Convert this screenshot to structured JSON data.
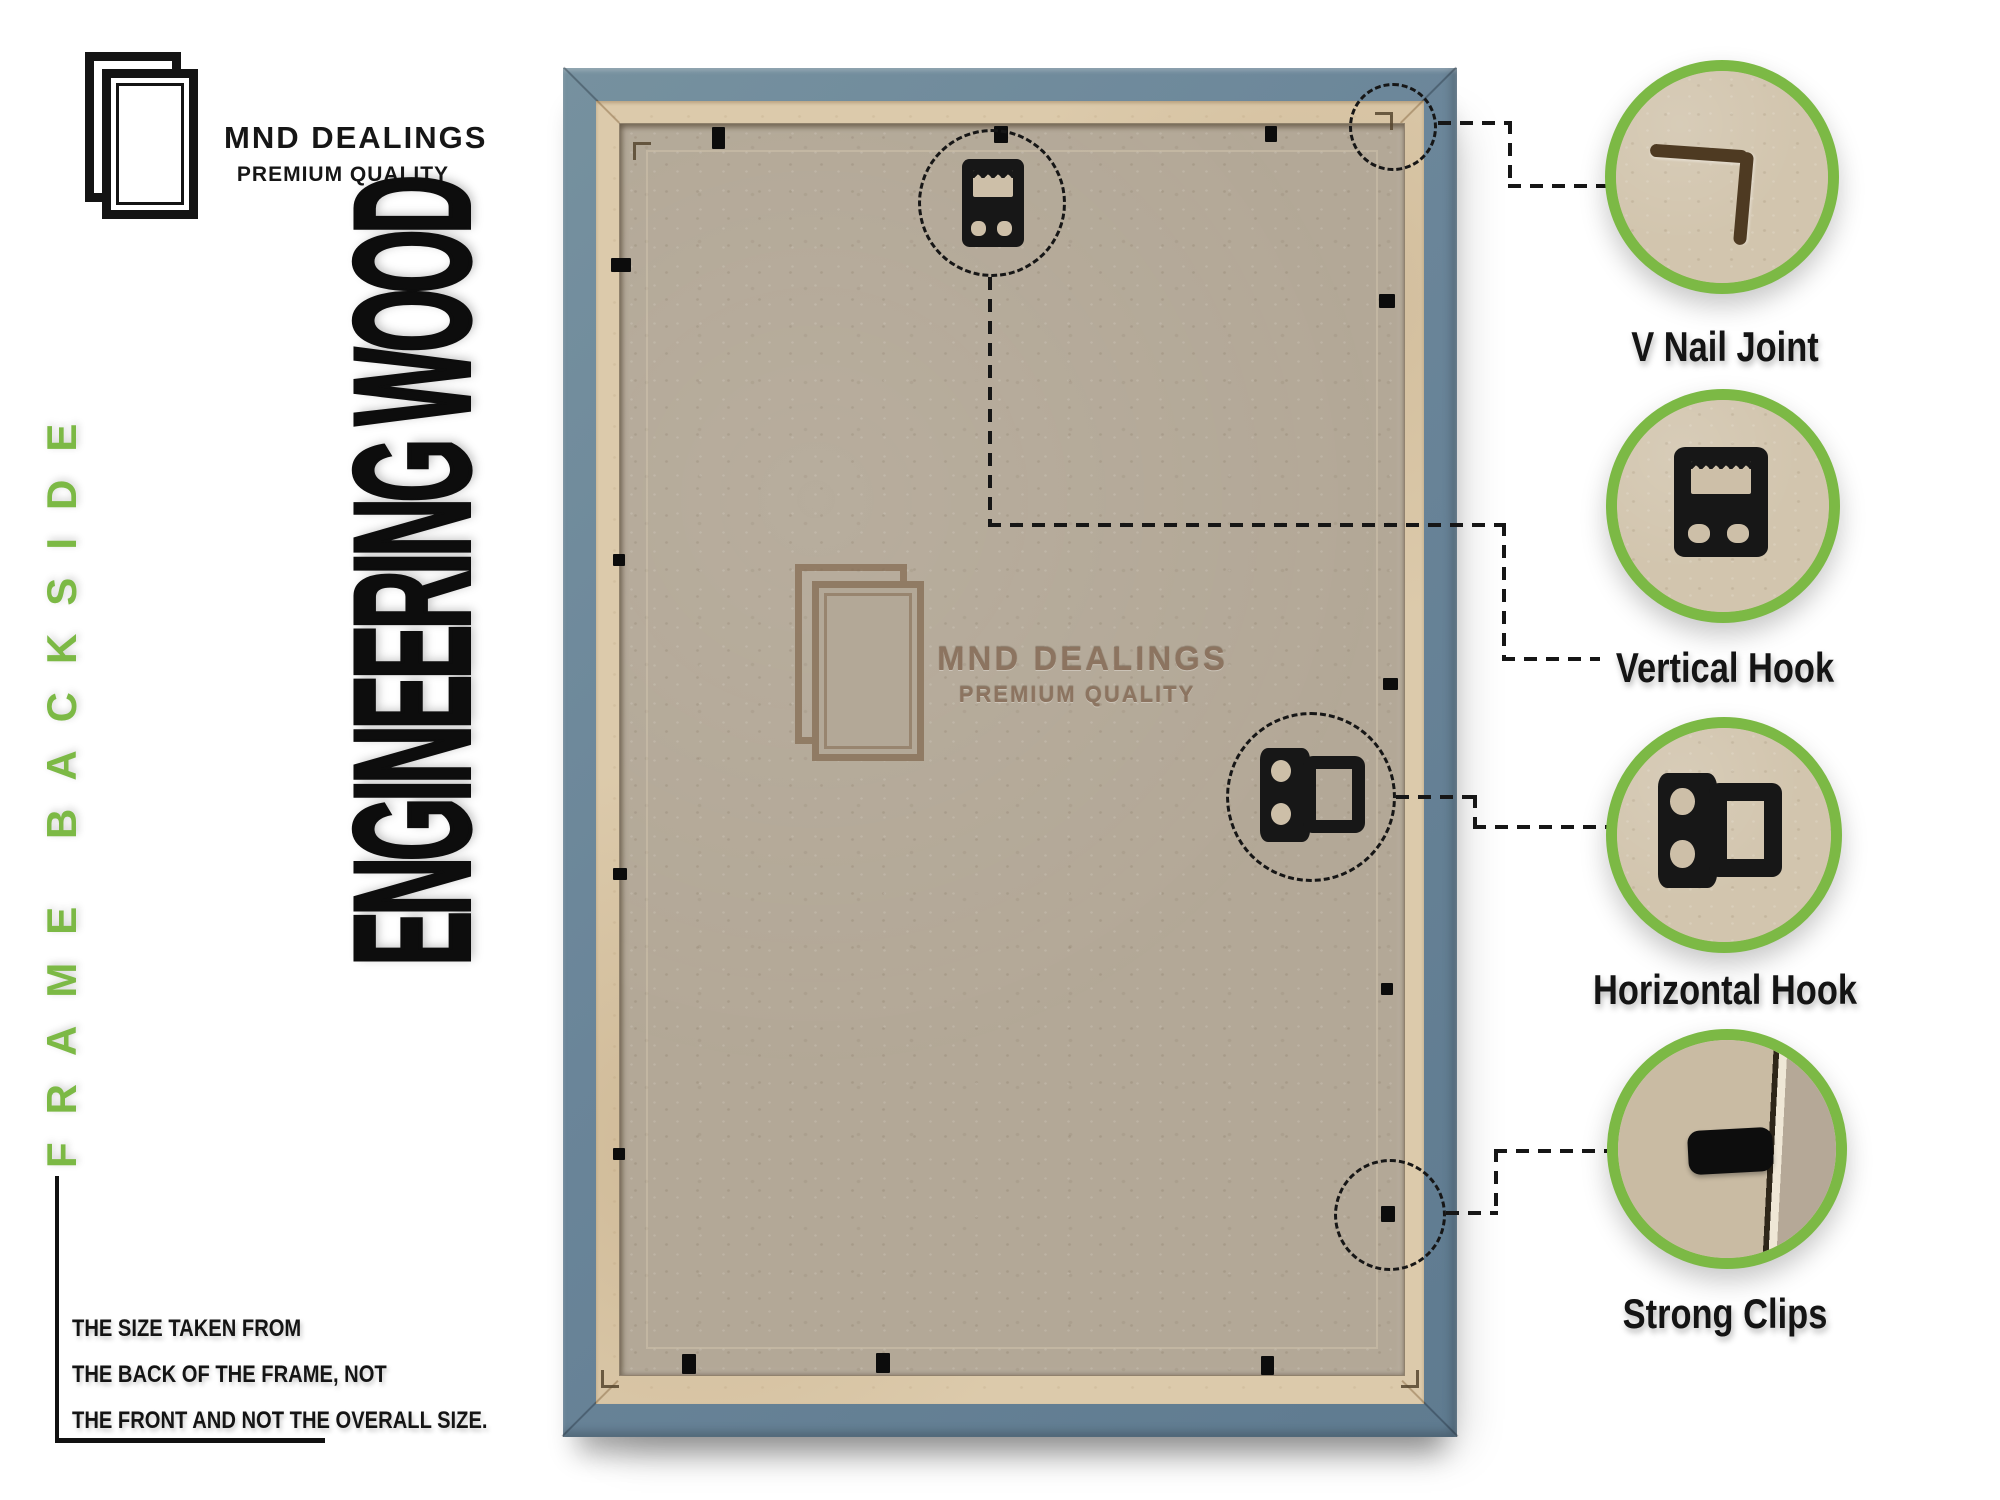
{
  "brand": {
    "name": "MND DEALINGS",
    "tagline": "PREMIUM QUALITY"
  },
  "side_label": "FRAME BACKSIDE",
  "material_label": "ENGINEERING WOOD",
  "size_note": {
    "line1": "THE SIZE TAKEN FROM",
    "line2": "THE BACK OF THE FRAME, NOT",
    "line3": "THE FRONT AND NOT THE OVERALL SIZE."
  },
  "watermark": {
    "name": "MND DEALINGS",
    "tagline": "PREMIUM QUALITY"
  },
  "callouts": [
    {
      "label": "V Nail Joint",
      "icon": "v-nail-joint-photo"
    },
    {
      "label": "Vertical Hook",
      "icon": "vertical-hook-photo"
    },
    {
      "label": "Horizontal Hook",
      "icon": "horizontal-hook-photo"
    },
    {
      "label": "Strong Clips",
      "icon": "strong-clip-photo"
    }
  ],
  "colors": {
    "accent_green": "#7cb945",
    "frame_blue": "#6a8599",
    "backing_kraft": "#b3a897",
    "border_tan": "#dccaab",
    "line_black": "#161616"
  }
}
